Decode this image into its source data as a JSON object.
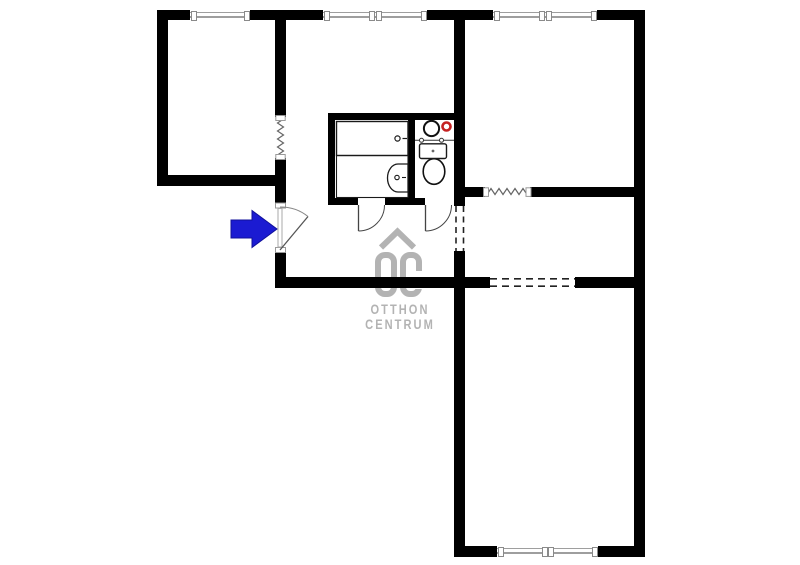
{
  "canvas": {
    "width": 800,
    "height": 565,
    "background": "#ffffff"
  },
  "watermark": {
    "line1": "OTTHON",
    "line2": "CENTRUM",
    "logo_text": "OC",
    "color": "#b3b3b3"
  },
  "entrance": {
    "direction": "right",
    "arrow_color": "#1b1bd2"
  },
  "palette": {
    "wall": "#000000",
    "window_line": "#9e9e9e",
    "window_cap_border": "#8a8a8a",
    "fixture_stroke": "#1a1a1a",
    "symbol_stroke": "#555555",
    "red_accent": "#c52222",
    "logo_gray": "#b3b3b3"
  },
  "walls": [
    {
      "name": "top-wall-segment",
      "kind": "exterior",
      "x": 157,
      "y": 10,
      "w": 33,
      "h": 10
    },
    {
      "name": "top-wall-segment",
      "kind": "exterior",
      "x": 250,
      "y": 10,
      "w": 73,
      "h": 10
    },
    {
      "name": "top-wall-segment",
      "kind": "exterior",
      "x": 427,
      "y": 10,
      "w": 66,
      "h": 10
    },
    {
      "name": "top-wall-segment",
      "kind": "exterior",
      "x": 597,
      "y": 10,
      "w": 48,
      "h": 10
    },
    {
      "name": "left-exterior-wall",
      "kind": "exterior",
      "x": 157,
      "y": 10,
      "w": 11,
      "h": 176
    },
    {
      "name": "right-exterior-wall",
      "kind": "exterior",
      "x": 634,
      "y": 10,
      "w": 11,
      "h": 547
    },
    {
      "name": "bottom-wall-segment",
      "kind": "exterior",
      "x": 454,
      "y": 546,
      "w": 43,
      "h": 11
    },
    {
      "name": "bottom-wall-segment",
      "kind": "exterior",
      "x": 598,
      "y": 546,
      "w": 47,
      "h": 11
    },
    {
      "name": "left-room-south-wall",
      "kind": "interior",
      "x": 157,
      "y": 175,
      "w": 129,
      "h": 11
    },
    {
      "name": "hall-west-wall-upper",
      "kind": "interior",
      "x": 275,
      "y": 20,
      "w": 11,
      "h": 97
    },
    {
      "name": "hall-west-wall-mid",
      "kind": "interior",
      "x": 275,
      "y": 158,
      "w": 11,
      "h": 46
    },
    {
      "name": "hall-west-wall-lower",
      "kind": "interior",
      "x": 275,
      "y": 251,
      "w": 11,
      "h": 37
    },
    {
      "name": "hall-south-wall",
      "kind": "interior",
      "x": 275,
      "y": 277,
      "w": 215,
      "h": 11
    },
    {
      "name": "dining-south-wall",
      "kind": "interior",
      "x": 575,
      "y": 277,
      "w": 70,
      "h": 11
    },
    {
      "name": "center-wall-upper",
      "kind": "interior",
      "x": 454,
      "y": 20,
      "w": 11,
      "h": 186
    },
    {
      "name": "center-wall-lower",
      "kind": "interior",
      "x": 454,
      "y": 251,
      "w": 11,
      "h": 306
    },
    {
      "name": "dining-north-wall-segment",
      "kind": "interior",
      "x": 454,
      "y": 187,
      "w": 31,
      "h": 10
    },
    {
      "name": "dining-north-wall-segment",
      "kind": "interior",
      "x": 530,
      "y": 187,
      "w": 104,
      "h": 10
    },
    {
      "name": "bathroom-north-wall",
      "kind": "partition",
      "x": 328,
      "y": 113,
      "w": 126,
      "h": 7
    },
    {
      "name": "bathroom-west-wall",
      "kind": "partition",
      "x": 328,
      "y": 113,
      "w": 7,
      "h": 92
    },
    {
      "name": "bathroom-south-wall-segment",
      "kind": "partition",
      "x": 328,
      "y": 198,
      "w": 30,
      "h": 7
    },
    {
      "name": "bathroom-south-wall-segment",
      "kind": "partition",
      "x": 385,
      "y": 198,
      "w": 40,
      "h": 7
    },
    {
      "name": "bathroom-wc-divider-wall",
      "kind": "partition",
      "x": 408,
      "y": 120,
      "w": 7,
      "h": 85
    }
  ],
  "windows": [
    {
      "name": "window-left-room",
      "x": 190,
      "y": 10,
      "w": 60,
      "h": 10,
      "mullion": false
    },
    {
      "name": "window-middle-room",
      "x": 323,
      "y": 10,
      "w": 104,
      "h": 10,
      "mullion": true
    },
    {
      "name": "window-right-room",
      "x": 493,
      "y": 10,
      "w": 104,
      "h": 10,
      "mullion": true
    },
    {
      "name": "window-bottom-room",
      "x": 497,
      "y": 546,
      "w": 101,
      "h": 11,
      "mullion": true
    }
  ],
  "svg_shapes": [
    {
      "name": "entrance-door-jamb",
      "type": "rect",
      "attrs": {
        "x": 275.5,
        "y": 203,
        "width": 10,
        "height": 5,
        "fill": "#ffffff",
        "stroke": "#999999",
        "stroke-width": 1
      }
    },
    {
      "name": "entrance-door-jamb",
      "type": "rect",
      "attrs": {
        "x": 275.5,
        "y": 247.5,
        "width": 10,
        "height": 5,
        "fill": "#ffffff",
        "stroke": "#999999",
        "stroke-width": 1
      }
    },
    {
      "name": "entrance-door-slab",
      "type": "rect",
      "attrs": {
        "x": 278,
        "y": 208.5,
        "width": 4,
        "height": 38.5,
        "fill": "#ffffff",
        "stroke": "#aaaaaa",
        "stroke-width": 1
      }
    },
    {
      "name": "entrance-door-leaf",
      "type": "line",
      "attrs": {
        "x1": 280,
        "y1": 250,
        "x2": 308,
        "y2": 216.5,
        "stroke": "#555555",
        "stroke-width": 1.3
      }
    },
    {
      "name": "entrance-door-swing-arc",
      "type": "path",
      "attrs": {
        "d": "M280,207 A43.5,43.5 0 0 1 308,216.5",
        "fill": "none",
        "stroke": "#888888",
        "stroke-width": 1
      }
    },
    {
      "name": "bathroom-door-leaf",
      "type": "line",
      "attrs": {
        "x1": 358.5,
        "y1": 205,
        "x2": 358.5,
        "y2": 231,
        "stroke": "#444444",
        "stroke-width": 1.3
      }
    },
    {
      "name": "bathroom-door-swing-arc",
      "type": "path",
      "attrs": {
        "d": "M358.5,231 A26,26 0 0 0 384.5,205",
        "fill": "none",
        "stroke": "#444444",
        "stroke-width": 1
      }
    },
    {
      "name": "wc-door-leaf",
      "type": "line",
      "attrs": {
        "x1": 425.5,
        "y1": 205,
        "x2": 425.5,
        "y2": 231,
        "stroke": "#444444",
        "stroke-width": 1.3
      }
    },
    {
      "name": "wc-door-swing-arc",
      "type": "path",
      "attrs": {
        "d": "M425.5,231 A26,26 0 0 0 451.5,205",
        "fill": "none",
        "stroke": "#444444",
        "stroke-width": 1
      }
    },
    {
      "name": "accordion-door-zigzag",
      "type": "polyline",
      "attrs": {
        "points": "283.5,119 277.5,123 283.5,127 277.5,131 283.5,135 277.5,139 283.5,143 277.5,147 283.5,151 277.5,155",
        "fill": "none",
        "stroke": "#666666",
        "stroke-width": 1.2
      }
    },
    {
      "name": "opening-cap",
      "type": "rect",
      "attrs": {
        "x": 275.8,
        "y": 115.5,
        "width": 9.4,
        "height": 5,
        "fill": "#ffffff",
        "stroke": "#999999",
        "stroke-width": 1
      }
    },
    {
      "name": "opening-cap",
      "type": "rect",
      "attrs": {
        "x": 275.8,
        "y": 154.5,
        "width": 9.4,
        "height": 5,
        "fill": "#ffffff",
        "stroke": "#999999",
        "stroke-width": 1
      }
    },
    {
      "name": "accordion-door-zigzag",
      "type": "polyline",
      "attrs": {
        "points": "487,194.5 491,188.5 495,194.5 499,188.5 503,194.5 507,188.5 511,194.5 515,188.5 519,194.5 523,188.5 527,194.5",
        "fill": "none",
        "stroke": "#666666",
        "stroke-width": 1.2
      }
    },
    {
      "name": "opening-cap",
      "type": "rect",
      "attrs": {
        "x": 483.5,
        "y": 187.8,
        "width": 5,
        "height": 8.6,
        "fill": "#ffffff",
        "stroke": "#999999",
        "stroke-width": 1
      }
    },
    {
      "name": "opening-cap",
      "type": "rect",
      "attrs": {
        "x": 526,
        "y": 187.8,
        "width": 5,
        "height": 8.6,
        "fill": "#ffffff",
        "stroke": "#999999",
        "stroke-width": 1
      }
    },
    {
      "name": "open-passage-dashed-line",
      "type": "line",
      "attrs": {
        "x1": 456,
        "y1": 206,
        "x2": 456,
        "y2": 251,
        "stroke": "#222222",
        "stroke-width": 1.6,
        "stroke-dasharray": "6,4.5"
      }
    },
    {
      "name": "open-passage-dashed-line",
      "type": "line",
      "attrs": {
        "x1": 463.5,
        "y1": 206,
        "x2": 463.5,
        "y2": 251,
        "stroke": "#222222",
        "stroke-width": 1.6,
        "stroke-dasharray": "6,4.5"
      }
    },
    {
      "name": "open-passage-dashed-line",
      "type": "line",
      "attrs": {
        "x1": 490,
        "y1": 278.8,
        "x2": 575,
        "y2": 278.8,
        "stroke": "#222222",
        "stroke-width": 1.6,
        "stroke-dasharray": "7,5"
      }
    },
    {
      "name": "open-passage-dashed-line",
      "type": "line",
      "attrs": {
        "x1": 490,
        "y1": 286.2,
        "x2": 575,
        "y2": 286.2,
        "stroke": "#222222",
        "stroke-width": 1.6,
        "stroke-dasharray": "7,5"
      }
    },
    {
      "name": "bathtub",
      "type": "rect",
      "attrs": {
        "x": 336.5,
        "y": 121.5,
        "width": 71.5,
        "height": 34,
        "fill": "#ffffff",
        "stroke": "#1a1a1a",
        "stroke-width": 1.4
      }
    },
    {
      "name": "bathtub-drain",
      "type": "circle",
      "attrs": {
        "cx": 397.5,
        "cy": 138.5,
        "r": 2.6,
        "fill": "#ffffff",
        "stroke": "#1a1a1a",
        "stroke-width": 1.2
      }
    },
    {
      "name": "bathtub-tap",
      "type": "line",
      "attrs": {
        "x1": 402.5,
        "y1": 138.5,
        "x2": 407,
        "y2": 138.5,
        "stroke": "#1a1a1a",
        "stroke-width": 1.2
      }
    },
    {
      "name": "bathroom-floor-outline",
      "type": "rect",
      "attrs": {
        "x": 336.5,
        "y": 155.5,
        "width": 71.5,
        "height": 42,
        "fill": "none",
        "stroke": "#1a1a1a",
        "stroke-width": 1.1
      }
    },
    {
      "name": "bathroom-washbasin",
      "type": "path",
      "attrs": {
        "d": "M408,164 L398,164 A10.5,14 0 1 0 398,192 L408,192 Z",
        "fill": "#ffffff",
        "stroke": "#1a1a1a",
        "stroke-width": 1.3
      }
    },
    {
      "name": "washbasin-drain",
      "type": "circle",
      "attrs": {
        "cx": 397,
        "cy": 177.5,
        "r": 2.2,
        "fill": "#ffffff",
        "stroke": "#1a1a1a",
        "stroke-width": 1.1
      }
    },
    {
      "name": "washbasin-tap",
      "type": "line",
      "attrs": {
        "x1": 402,
        "y1": 177.5,
        "x2": 406,
        "y2": 177.5,
        "stroke": "#1a1a1a",
        "stroke-width": 1.1
      }
    },
    {
      "name": "washing-machine",
      "type": "circle",
      "attrs": {
        "cx": 431.5,
        "cy": 128.5,
        "r": 7.6,
        "fill": "#ffffff",
        "stroke": "#111111",
        "stroke-width": 2
      }
    },
    {
      "name": "boiler-indicator",
      "type": "circle",
      "attrs": {
        "cx": 446.5,
        "cy": 126.5,
        "r": 4,
        "fill": "#ffffff",
        "stroke": "#c52222",
        "stroke-width": 2.6
      }
    },
    {
      "name": "wc-shelf-line",
      "type": "line",
      "attrs": {
        "x1": 415,
        "y1": 140.3,
        "x2": 454,
        "y2": 140.3,
        "stroke": "#333333",
        "stroke-width": 1
      }
    },
    {
      "name": "wc-tap",
      "type": "circle",
      "attrs": {
        "cx": 421.5,
        "cy": 140.3,
        "r": 2,
        "fill": "#ffffff",
        "stroke": "#333333",
        "stroke-width": 1
      }
    },
    {
      "name": "wc-tap",
      "type": "circle",
      "attrs": {
        "cx": 441.5,
        "cy": 140.3,
        "r": 2,
        "fill": "#ffffff",
        "stroke": "#333333",
        "stroke-width": 1
      }
    },
    {
      "name": "toilet-bowl",
      "type": "ellipse",
      "attrs": {
        "cx": 434,
        "cy": 171.5,
        "rx": 10.8,
        "ry": 12.8,
        "fill": "#ffffff",
        "stroke": "#111111",
        "stroke-width": 1.6
      }
    },
    {
      "name": "wc-washbasin",
      "type": "rect",
      "attrs": {
        "x": 419.5,
        "y": 143.8,
        "width": 27,
        "height": 14.7,
        "rx": 2,
        "fill": "#ffffff",
        "stroke": "#1a1a1a",
        "stroke-width": 1.4
      }
    },
    {
      "name": "wc-washbasin-drain",
      "type": "circle",
      "attrs": {
        "cx": 433,
        "cy": 151,
        "r": 1.4,
        "fill": "#666666"
      }
    },
    {
      "name": "entrance-arrow",
      "type": "polygon",
      "attrs": {
        "points": "231,220 252,220 252,210.5 277,229 252,247.5 252,238 231,238",
        "fill": "#1b1bd2",
        "stroke": "#11119b",
        "stroke-width": 1
      }
    },
    {
      "name": "logo-roof-icon",
      "type": "polyline",
      "attrs": {
        "points": "381,247.5 397.5,231.5 414,247.5",
        "fill": "none",
        "stroke": "#b3b3b3",
        "stroke-width": 6
      }
    }
  ]
}
